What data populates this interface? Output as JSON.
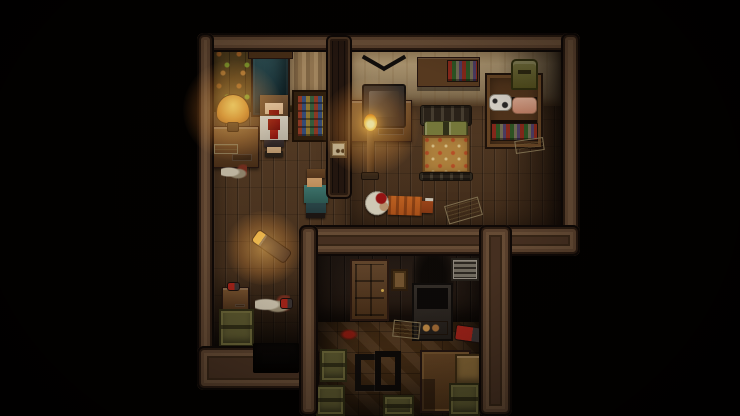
{
  "scene": {
    "description": "Top-down pixel-art horror RPG interior: three connected wooden rooms on black void; bloodied woman in upper-left room, walking man in hallway, bandaged body in orange suit on bedroom floor, cluttered storage room below",
    "canvas": {
      "width": 740,
      "height": 416,
      "background": "#000000"
    },
    "palette": {
      "void": "#000000",
      "wall_frame": "#4a3323",
      "wall_frame_light": "#6e523a",
      "wall_frame_dark": "#0d0806",
      "floor_planks": "#4e341f",
      "floor_parquet": "#503418",
      "wallpaper_ornament": "#57431f",
      "wallpaper_beige": "#bfa87f",
      "door_teal": "#2a4c52",
      "lamp_glow": "#ffaf46",
      "blood": "#9a1a12",
      "victim_suit_orange": "#cf6a24",
      "crate_olive": "#5d5a30"
    },
    "entities": [
      {
        "n": "hallway-floor",
        "t": "floor-planks",
        "x": 213,
        "y": 100,
        "w": 139,
        "h": 250,
        "z": 1,
        "i": false
      },
      {
        "n": "bedroom-floor",
        "t": "floor-planks",
        "x": 350,
        "y": 98,
        "w": 212,
        "h": 130,
        "z": 1,
        "i": false
      },
      {
        "n": "storage-room-floor",
        "t": "floor-parquet",
        "x": 316,
        "y": 314,
        "w": 166,
        "h": 102,
        "z": 2,
        "i": false
      },
      {
        "n": "left-room-wallpaper",
        "t": "wall-ornament",
        "x": 213,
        "y": 46,
        "w": 118,
        "h": 66,
        "z": 3,
        "i": false
      },
      {
        "n": "bedroom-wallpaper",
        "t": "wall-beige",
        "x": 350,
        "y": 46,
        "w": 212,
        "h": 60,
        "z": 3,
        "i": false
      },
      {
        "n": "storage-room-wall",
        "t": "wall-darkplanks",
        "x": 316,
        "y": 246,
        "w": 166,
        "h": 76,
        "z": 3,
        "i": false
      },
      {
        "n": "bedroom-right-shadow",
        "t": "shade-right",
        "x": 498,
        "y": 46,
        "w": 64,
        "h": 182,
        "z": 4,
        "i": false
      },
      {
        "n": "hallway-bottom-shadow",
        "t": "shade-bottom",
        "x": 213,
        "y": 268,
        "w": 88,
        "h": 82,
        "z": 4,
        "i": false
      },
      {
        "n": "storage-room-shadow",
        "t": "shade-inset",
        "x": 316,
        "y": 246,
        "w": 166,
        "h": 170,
        "z": 4,
        "i": false
      },
      {
        "n": "lamp-desk",
        "t": "desk",
        "x": 209,
        "y": 126,
        "w": 50,
        "h": 42,
        "z": 5,
        "i": false
      },
      {
        "n": "table-lamp-shade",
        "t": "lamp-shade",
        "x": 216,
        "y": 94,
        "w": 34,
        "h": 30,
        "z": 5,
        "i": false
      },
      {
        "n": "table-lamp-base",
        "t": "lamp-base",
        "x": 227,
        "y": 122,
        "w": 12,
        "h": 10,
        "z": 5,
        "i": false
      },
      {
        "n": "white-bowl",
        "t": "paper",
        "x": 214,
        "y": 144,
        "w": 24,
        "h": 10,
        "z": 5,
        "i": false
      },
      {
        "n": "floor-debris-left",
        "t": "debris",
        "x": 221,
        "y": 164,
        "w": 26,
        "h": 16,
        "z": 5,
        "i": false
      },
      {
        "n": "torn-curtain",
        "t": "curtain-tan",
        "x": 289,
        "y": 48,
        "w": 41,
        "h": 58,
        "z": 5,
        "i": false
      },
      {
        "n": "stained-glass-cabinet",
        "t": "cabinet-stained",
        "x": 292,
        "y": 90,
        "w": 37,
        "h": 52,
        "z": 5,
        "i": false
      },
      {
        "n": "upper-door",
        "t": "door-teal",
        "x": 251,
        "y": 54,
        "w": 39,
        "h": 63,
        "z": 5,
        "i": true
      },
      {
        "n": "upper-door-lintel",
        "t": "lintel",
        "x": 248,
        "y": 49,
        "w": 45,
        "h": 10,
        "z": 5,
        "i": false
      },
      {
        "n": "tv-stand",
        "t": "desk",
        "x": 348,
        "y": 100,
        "w": 64,
        "h": 42,
        "z": 5,
        "i": false
      },
      {
        "n": "tv-antenna",
        "t": "tv-antenna",
        "x": 360,
        "y": 56,
        "w": 48,
        "h": 32,
        "z": 5,
        "i": false
      },
      {
        "n": "tv-set",
        "t": "tv",
        "x": 362,
        "y": 84,
        "w": 44,
        "h": 44,
        "z": 5,
        "i": false
      },
      {
        "n": "candle-stand-pole",
        "t": "candle-pole",
        "x": 367,
        "y": 128,
        "w": 7,
        "h": 48,
        "z": 5,
        "i": false
      },
      {
        "n": "candle-stand-base",
        "t": "lamp-base",
        "x": 361,
        "y": 172,
        "w": 18,
        "h": 8,
        "z": 5,
        "i": false
      },
      {
        "n": "candle-flame",
        "t": "flame",
        "x": 364,
        "y": 114,
        "w": 13,
        "h": 17,
        "z": 5,
        "i": false
      },
      {
        "n": "wall-shelf",
        "t": "shelf-board",
        "x": 417,
        "y": 57,
        "w": 63,
        "h": 30,
        "z": 5,
        "i": false
      },
      {
        "n": "wall-shelf-books",
        "t": "books",
        "x": 447,
        "y": 60,
        "w": 31,
        "h": 22,
        "z": 5,
        "i": false
      },
      {
        "n": "bed-head-rail",
        "t": "bed-rail",
        "x": 420,
        "y": 105,
        "w": 52,
        "h": 21,
        "z": 5,
        "i": false
      },
      {
        "n": "bed-pillows",
        "t": "pillows",
        "x": 424,
        "y": 121,
        "w": 44,
        "h": 17,
        "z": 5,
        "i": false
      },
      {
        "n": "bed-blanket",
        "t": "blanket",
        "x": 422,
        "y": 135,
        "w": 48,
        "h": 39,
        "z": 5,
        "i": false
      },
      {
        "n": "bed-foot-rail",
        "t": "bed-rail",
        "x": 419,
        "y": 172,
        "w": 54,
        "h": 9,
        "z": 5,
        "i": false
      },
      {
        "n": "bookshelf",
        "t": "bookshelf",
        "x": 485,
        "y": 73,
        "w": 58,
        "h": 76,
        "z": 5,
        "i": false
      },
      {
        "n": "bookshelf-bag",
        "t": "bag",
        "x": 511,
        "y": 59,
        "w": 27,
        "h": 31,
        "z": 5,
        "i": false
      },
      {
        "n": "shelf-cow-cloth",
        "t": "cow-cloth",
        "x": 489,
        "y": 94,
        "w": 23,
        "h": 17,
        "z": 5,
        "i": false
      },
      {
        "n": "shelf-pink-cloth",
        "t": "pink-cloth",
        "x": 512,
        "y": 97,
        "w": 25,
        "h": 17,
        "z": 5,
        "i": false
      },
      {
        "n": "shelf-books-row",
        "t": "books",
        "x": 491,
        "y": 123,
        "w": 47,
        "h": 18,
        "z": 5,
        "i": false
      },
      {
        "n": "floor-paper-right",
        "t": "paper",
        "x": 515,
        "y": 139,
        "w": 29,
        "h": 13,
        "z": 5,
        "r": -8,
        "i": true
      },
      {
        "n": "floor-note",
        "t": "paper",
        "x": 446,
        "y": 201,
        "w": 35,
        "h": 19,
        "z": 5,
        "r": -16,
        "i": true
      },
      {
        "n": "body-victim",
        "t": "body-victim",
        "x": 363,
        "y": 188,
        "w": 71,
        "h": 34,
        "z": 6,
        "r": 2,
        "i": true
      },
      {
        "n": "flashlight",
        "t": "flashlight",
        "x": 251,
        "y": 239,
        "w": 41,
        "h": 15,
        "z": 5,
        "r": 35,
        "i": true
      },
      {
        "n": "hallway-side-table",
        "t": "desk",
        "x": 222,
        "y": 287,
        "w": 27,
        "h": 25,
        "z": 5,
        "i": false
      },
      {
        "n": "red-bottle",
        "t": "tool-red",
        "x": 227,
        "y": 282,
        "w": 13,
        "h": 9,
        "z": 5,
        "i": false
      },
      {
        "n": "hallway-crate",
        "t": "crate-olive",
        "x": 219,
        "y": 309,
        "w": 35,
        "h": 38,
        "z": 5,
        "i": false
      },
      {
        "n": "hallway-cloth-debris",
        "t": "debris",
        "x": 255,
        "y": 295,
        "w": 35,
        "h": 19,
        "z": 5,
        "i": false
      },
      {
        "n": "hallway-red-item",
        "t": "tool-red",
        "x": 280,
        "y": 298,
        "w": 13,
        "h": 11,
        "z": 5,
        "i": false
      },
      {
        "n": "storage-door",
        "t": "door-brown",
        "x": 350,
        "y": 259,
        "w": 39,
        "h": 62,
        "z": 5,
        "i": true
      },
      {
        "n": "small-wall-frame",
        "t": "wall-frame-small",
        "x": 391,
        "y": 269,
        "w": 17,
        "h": 22,
        "z": 5,
        "i": false
      },
      {
        "n": "soot-burn-mark",
        "t": "soot",
        "x": 412,
        "y": 244,
        "w": 42,
        "h": 48,
        "z": 5,
        "i": false
      },
      {
        "n": "stove",
        "t": "stove",
        "x": 412,
        "y": 283,
        "w": 41,
        "h": 58,
        "z": 5,
        "i": false
      },
      {
        "n": "air-vent",
        "t": "vent",
        "x": 451,
        "y": 258,
        "w": 28,
        "h": 23,
        "z": 5,
        "i": false
      },
      {
        "n": "storage-floor-papers",
        "t": "paper",
        "x": 393,
        "y": 321,
        "w": 27,
        "h": 17,
        "z": 5,
        "r": 6,
        "i": true
      },
      {
        "n": "blood-stain",
        "t": "blood",
        "x": 340,
        "y": 329,
        "w": 18,
        "h": 11,
        "z": 5,
        "i": false
      },
      {
        "n": "red-drill-tool",
        "t": "tool-red",
        "x": 455,
        "y": 326,
        "w": 29,
        "h": 16,
        "z": 5,
        "r": 8,
        "i": true
      },
      {
        "n": "fallen-chair",
        "t": "chair-fallen",
        "x": 353,
        "y": 349,
        "w": 51,
        "h": 39,
        "z": 5,
        "i": false
      },
      {
        "n": "storage-table",
        "t": "table-brown",
        "x": 420,
        "y": 350,
        "w": 51,
        "h": 63,
        "z": 5,
        "i": false
      },
      {
        "n": "crate-left-top",
        "t": "crate-olive",
        "x": 320,
        "y": 349,
        "w": 27,
        "h": 33,
        "z": 5,
        "i": false
      },
      {
        "n": "crate-left-bottom",
        "t": "crate-olive",
        "x": 316,
        "y": 385,
        "w": 29,
        "h": 31,
        "z": 5,
        "i": false
      },
      {
        "n": "crate-right-top",
        "t": "crate-tan",
        "x": 455,
        "y": 354,
        "w": 27,
        "h": 31,
        "z": 5,
        "i": false
      },
      {
        "n": "crate-right-bottom",
        "t": "crate-olive",
        "x": 449,
        "y": 383,
        "w": 31,
        "h": 33,
        "z": 5,
        "i": false
      },
      {
        "n": "crate-bottom-middle",
        "t": "crate-olive",
        "x": 383,
        "y": 395,
        "w": 31,
        "h": 21,
        "z": 5,
        "i": false
      },
      {
        "n": "woman-bloody",
        "t": "woman",
        "x": 256,
        "y": 95,
        "w": 36,
        "h": 63,
        "z": 6,
        "i": true
      },
      {
        "n": "man-walking",
        "t": "man",
        "x": 300,
        "y": 167,
        "w": 32,
        "h": 52,
        "z": 6,
        "i": true
      },
      {
        "n": "wall-top",
        "t": "wall",
        "x": 197,
        "y": 33,
        "w": 383,
        "h": 19,
        "z": 7,
        "i": false
      },
      {
        "n": "wall-left",
        "t": "wall",
        "x": 197,
        "y": 33,
        "w": 17,
        "h": 357,
        "z": 7,
        "i": false
      },
      {
        "n": "wall-right",
        "t": "wall",
        "x": 561,
        "y": 33,
        "w": 19,
        "h": 223,
        "z": 7,
        "i": false
      },
      {
        "n": "wall-bottom-upper",
        "t": "wall",
        "x": 299,
        "y": 225,
        "w": 281,
        "h": 31,
        "z": 7,
        "i": false
      },
      {
        "n": "wall-hallway-bottom",
        "t": "wall",
        "x": 197,
        "y": 346,
        "w": 122,
        "h": 44,
        "z": 7,
        "i": false
      },
      {
        "n": "wall-storage-left",
        "t": "wall",
        "x": 299,
        "y": 225,
        "w": 19,
        "h": 191,
        "z": 7,
        "i": false
      },
      {
        "n": "wall-storage-right",
        "t": "wall",
        "x": 479,
        "y": 225,
        "w": 33,
        "h": 191,
        "z": 7,
        "i": false
      },
      {
        "n": "divider-wall",
        "t": "wall-divider",
        "x": 326,
        "y": 35,
        "w": 26,
        "h": 164,
        "z": 7,
        "i": false
      },
      {
        "n": "light-switch",
        "t": "light-switch",
        "x": 330,
        "y": 141,
        "w": 17,
        "h": 17,
        "z": 8,
        "i": true
      },
      {
        "n": "dark-passage",
        "t": "black-opening",
        "x": 253,
        "y": 343,
        "w": 46,
        "h": 30,
        "z": 8,
        "i": true
      },
      {
        "n": "lamp-glow",
        "t": "glow",
        "x": 183,
        "y": 60,
        "w": 100,
        "h": 100,
        "z": 9,
        "i": false
      },
      {
        "n": "candle-glow",
        "t": "glow",
        "x": 321,
        "y": 78,
        "w": 98,
        "h": 98,
        "z": 9,
        "i": false
      },
      {
        "n": "flashlight-glow",
        "t": "glow",
        "x": 225,
        "y": 211,
        "w": 78,
        "h": 74,
        "z": 9,
        "i": false
      },
      {
        "n": "vignette",
        "t": "vignette",
        "x": 0,
        "y": 0,
        "w": 740,
        "h": 416,
        "z": 10,
        "i": false
      }
    ]
  }
}
